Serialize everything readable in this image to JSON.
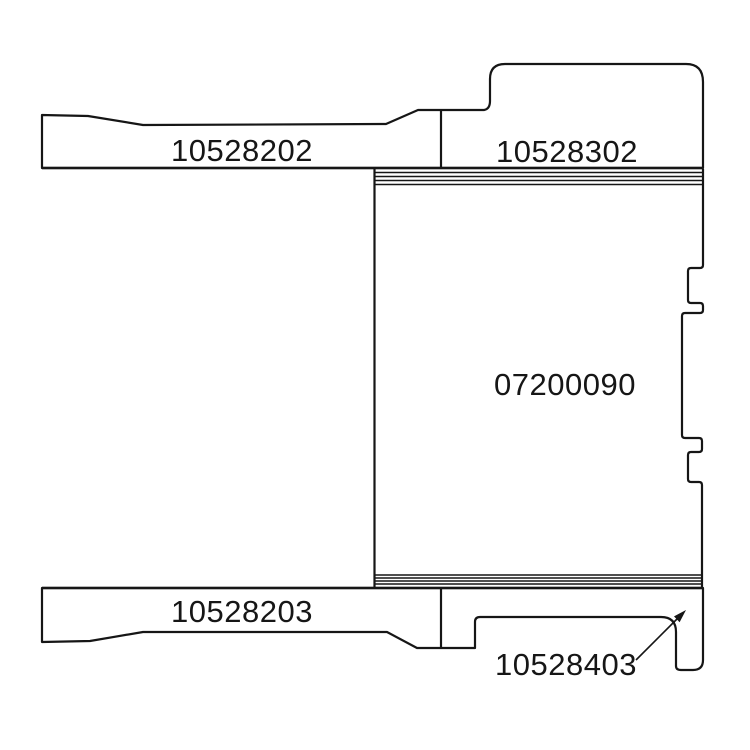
{
  "figure": {
    "type": "technical-cross-section-parts-diagram",
    "background_color": "#ffffff",
    "line_color": "#161616",
    "parts": [
      {
        "name": "top-left-plate",
        "part_number": "10528202"
      },
      {
        "name": "top-right-cap",
        "part_number": "10528302"
      },
      {
        "name": "center-body",
        "part_number": "07200090"
      },
      {
        "name": "bottom-left-plate",
        "part_number": "10528203"
      },
      {
        "name": "bottom-right-bracket",
        "part_number": "10528403"
      }
    ],
    "callout": {
      "target_part": "10528403",
      "style": "leader-arrow"
    }
  }
}
